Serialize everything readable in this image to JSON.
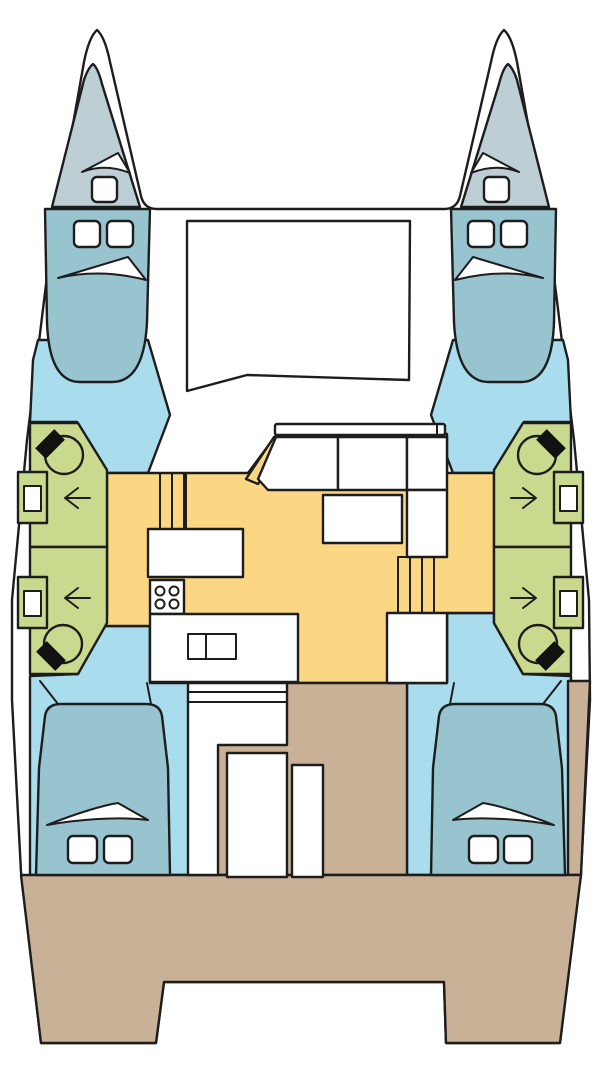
{
  "diagram": {
    "kind": "catamaran-deck-plan",
    "view": "top-down layout plan",
    "text_labels": []
  },
  "colors": {
    "background": "#ffffff",
    "hull": "#ffffff",
    "outline": "#1d1d1d",
    "forepeak": "#bdcfd4",
    "cabin_floor": "#a9ddee",
    "bed": "#98c4cf",
    "head": "#c9da8f",
    "salon": "#fbd784",
    "cockpit": "#c9b197",
    "furniture": "#ffffff",
    "fixture_dark": "#111111"
  },
  "icons": {
    "port_head_door_arrow": "arrow-left",
    "starboard_head_door_arrow": "arrow-right"
  },
  "regions": {
    "port_forepeak": "crew berth",
    "starboard_forepeak": "crew berth",
    "port_forward_cabin": "double berth cabin",
    "starboard_forward_cabin": "double berth cabin",
    "port_forward_head": "bathroom",
    "port_aft_head": "bathroom",
    "starboard_forward_head": "bathroom",
    "starboard_aft_head": "bathroom",
    "salon_galley": "salon and galley",
    "port_aft_cabin": "double berth cabin",
    "starboard_aft_cabin": "double berth cabin",
    "cockpit": "aft cockpit and deck",
    "foredeck": "trampoline"
  }
}
